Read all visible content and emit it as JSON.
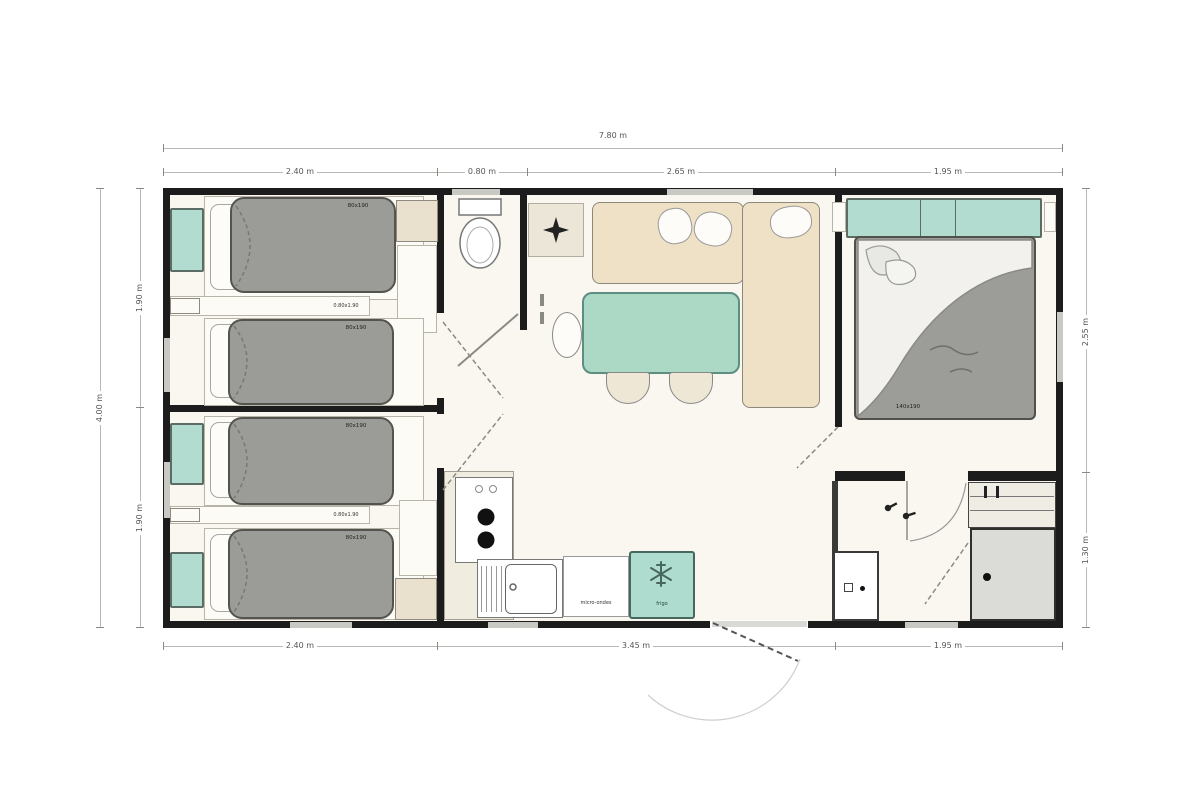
{
  "plan": {
    "dimensions": {
      "top_overall": "7.80 m",
      "top_seg": [
        "2.40 m",
        "0.80 m",
        "2.65 m",
        "1.95 m"
      ],
      "bottom_seg": [
        "2.40 m",
        "3.45 m",
        "1.95 m"
      ],
      "left_overall": "4.00 m",
      "left_seg": [
        "1.90 m",
        "1.90 m"
      ],
      "right_seg": [
        "2.55 m",
        "1.30 m"
      ]
    },
    "rooms": {
      "twin_bedroom_1": {
        "bed1": "80x190",
        "bed2": "80x190",
        "shelf": "0.80x1.90"
      },
      "twin_bedroom_2": {
        "bed1": "80x190",
        "bed2": "80x190",
        "shelf": "0.80x1.90"
      },
      "master_bedroom": {
        "bed": "140x190"
      },
      "kitchen": {
        "counter": "micro-ondes",
        "fridge": "frigo"
      }
    },
    "icons": {
      "wc": "toilet-icon",
      "hall_light": "ceiling-fan-icon",
      "fridge": "snowflake-icon",
      "hob": "burner-icons",
      "bathroom": "faucet-icons",
      "shower": "drain-icon"
    },
    "colors": {
      "teal_accent": "#b2dccf",
      "mattress_gray": "#9b9b97",
      "furniture_beige": "#e9e0ce",
      "wall_black": "#1c1c1c",
      "shower_gray": "#dbdbd7"
    }
  }
}
